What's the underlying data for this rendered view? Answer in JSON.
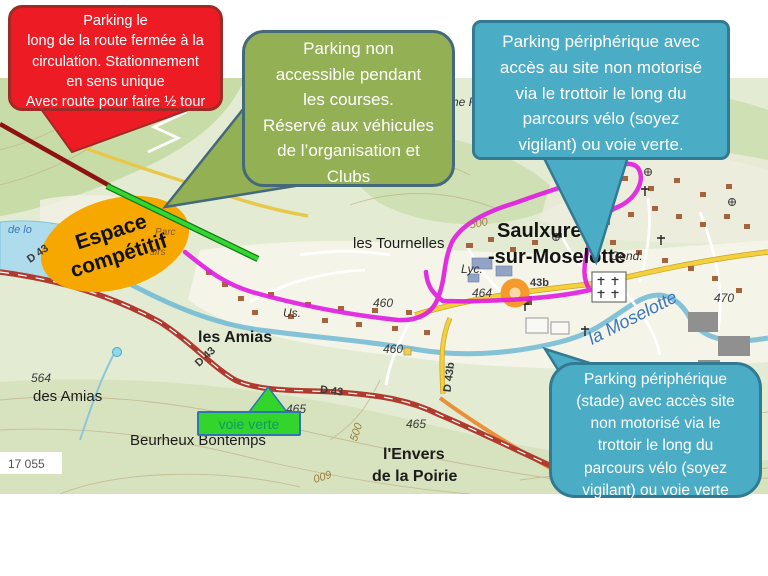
{
  "callouts": {
    "red": {
      "text": "Parking le\nlong de la route fermée à la\ncirculation. Stationnement\nen sens unique\nAvec route pour faire ½ tour",
      "fill": "#ED1C24",
      "border": "#9E2B25"
    },
    "green": {
      "text": "Parking non\naccessible pendant\nles  courses.\nRéservé aux véhicules\nde l’organisation et\nClubs",
      "fill": "#94B054",
      "border": "#44697A"
    },
    "blue_top": {
      "text": "Parking périphérique   avec\naccès au site non motorisé\nvia le  trottoir le long du\nparcours vélo (soyez\nvigilant) ou voie verte.",
      "fill": "#4BACC6",
      "border": "#327A92"
    },
    "blue_bottom": {
      "text": "Parking périphérique\n(stade)  avec  accès site\nnon motorisé via le\ntrottoir le long  du\nparcours vélo (soyez\nvigilant) ou voie verte",
      "fill": "#4BACC6",
      "border": "#327A92"
    }
  },
  "espace_label": {
    "line1": "Espace",
    "line2": "compétitif",
    "fill": "#F7A800"
  },
  "voie_verte": {
    "text": "voie verte",
    "fill": "#33D42C",
    "text_color": "#0E9B63",
    "border": "#2E75B6"
  },
  "route_colors": {
    "race_route": "#E01FE0",
    "voie_verte_line": "#32D732",
    "closed_road": "#8E1212"
  },
  "map": {
    "labels": {
      "saulxures1": "Saulxures",
      "saulxures2": "-sur-Moselotte",
      "tournelles": "les Tournelles",
      "les_amias": "les Amias",
      "des_amias": "des Amias",
      "la_moselotte": "la Moselotte",
      "gend": "Gend.",
      "lyc": "Lyc.",
      "us": "Us.",
      "beurheux": "Beurheux Bontemps",
      "envers1": "l'Envers",
      "envers2": "de la Poirie",
      "d43_a": "D 43",
      "d43_b": "D 43",
      "d43_c": "D 43",
      "d43b_vert": "D 43b",
      "n43b": "43b",
      "n464": "464",
      "n460a": "460",
      "n460b": "460",
      "n465a": "465",
      "n465b": "465",
      "n470": "470",
      "n500a": "500",
      "n500b": "500",
      "n600": "600",
      "n564": "564",
      "sheet_number": "17 055",
      "che_fragment": "che R",
      "de_lo_fragment": "de lo",
      "parc_fragment": "Parc",
      "sirs_fragment": "sirs"
    }
  }
}
